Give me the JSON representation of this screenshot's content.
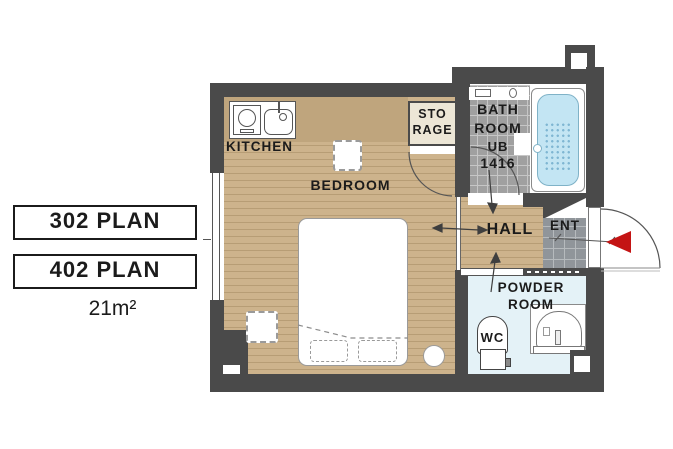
{
  "plan_selector": {
    "plans": [
      {
        "label": "302 PLAN"
      },
      {
        "label": "402 PLAN"
      }
    ],
    "area_label": "21m²"
  },
  "floorplan": {
    "rooms": {
      "kitchen": {
        "label": "KITCHEN"
      },
      "bedroom": {
        "label": "BEDROOM"
      },
      "storage": {
        "lines": [
          "STO",
          "RAGE"
        ]
      },
      "bathroom": {
        "lines": [
          "BATH",
          "ROOM",
          "UB",
          "1416"
        ]
      },
      "hall": {
        "label": "HALL"
      },
      "entrance": {
        "label": "ENT"
      },
      "powder_room": {
        "lines": [
          "POWDER",
          "ROOM"
        ]
      },
      "wc": {
        "label": "WC"
      }
    },
    "colors": {
      "wall": "#4a4a4a",
      "wood_floor": "#cdb38c",
      "wood_stripe": "#b79d75",
      "kitchen_counter": "#bfa57d",
      "bath_tile": "#a0a0a0",
      "entrance_tile": "#90959a",
      "bathtub": "#c3e5f3",
      "powder_floor": "#e4f2f7",
      "storage_fill": "#ece6d6",
      "entry_arrow": "#c41414"
    }
  }
}
